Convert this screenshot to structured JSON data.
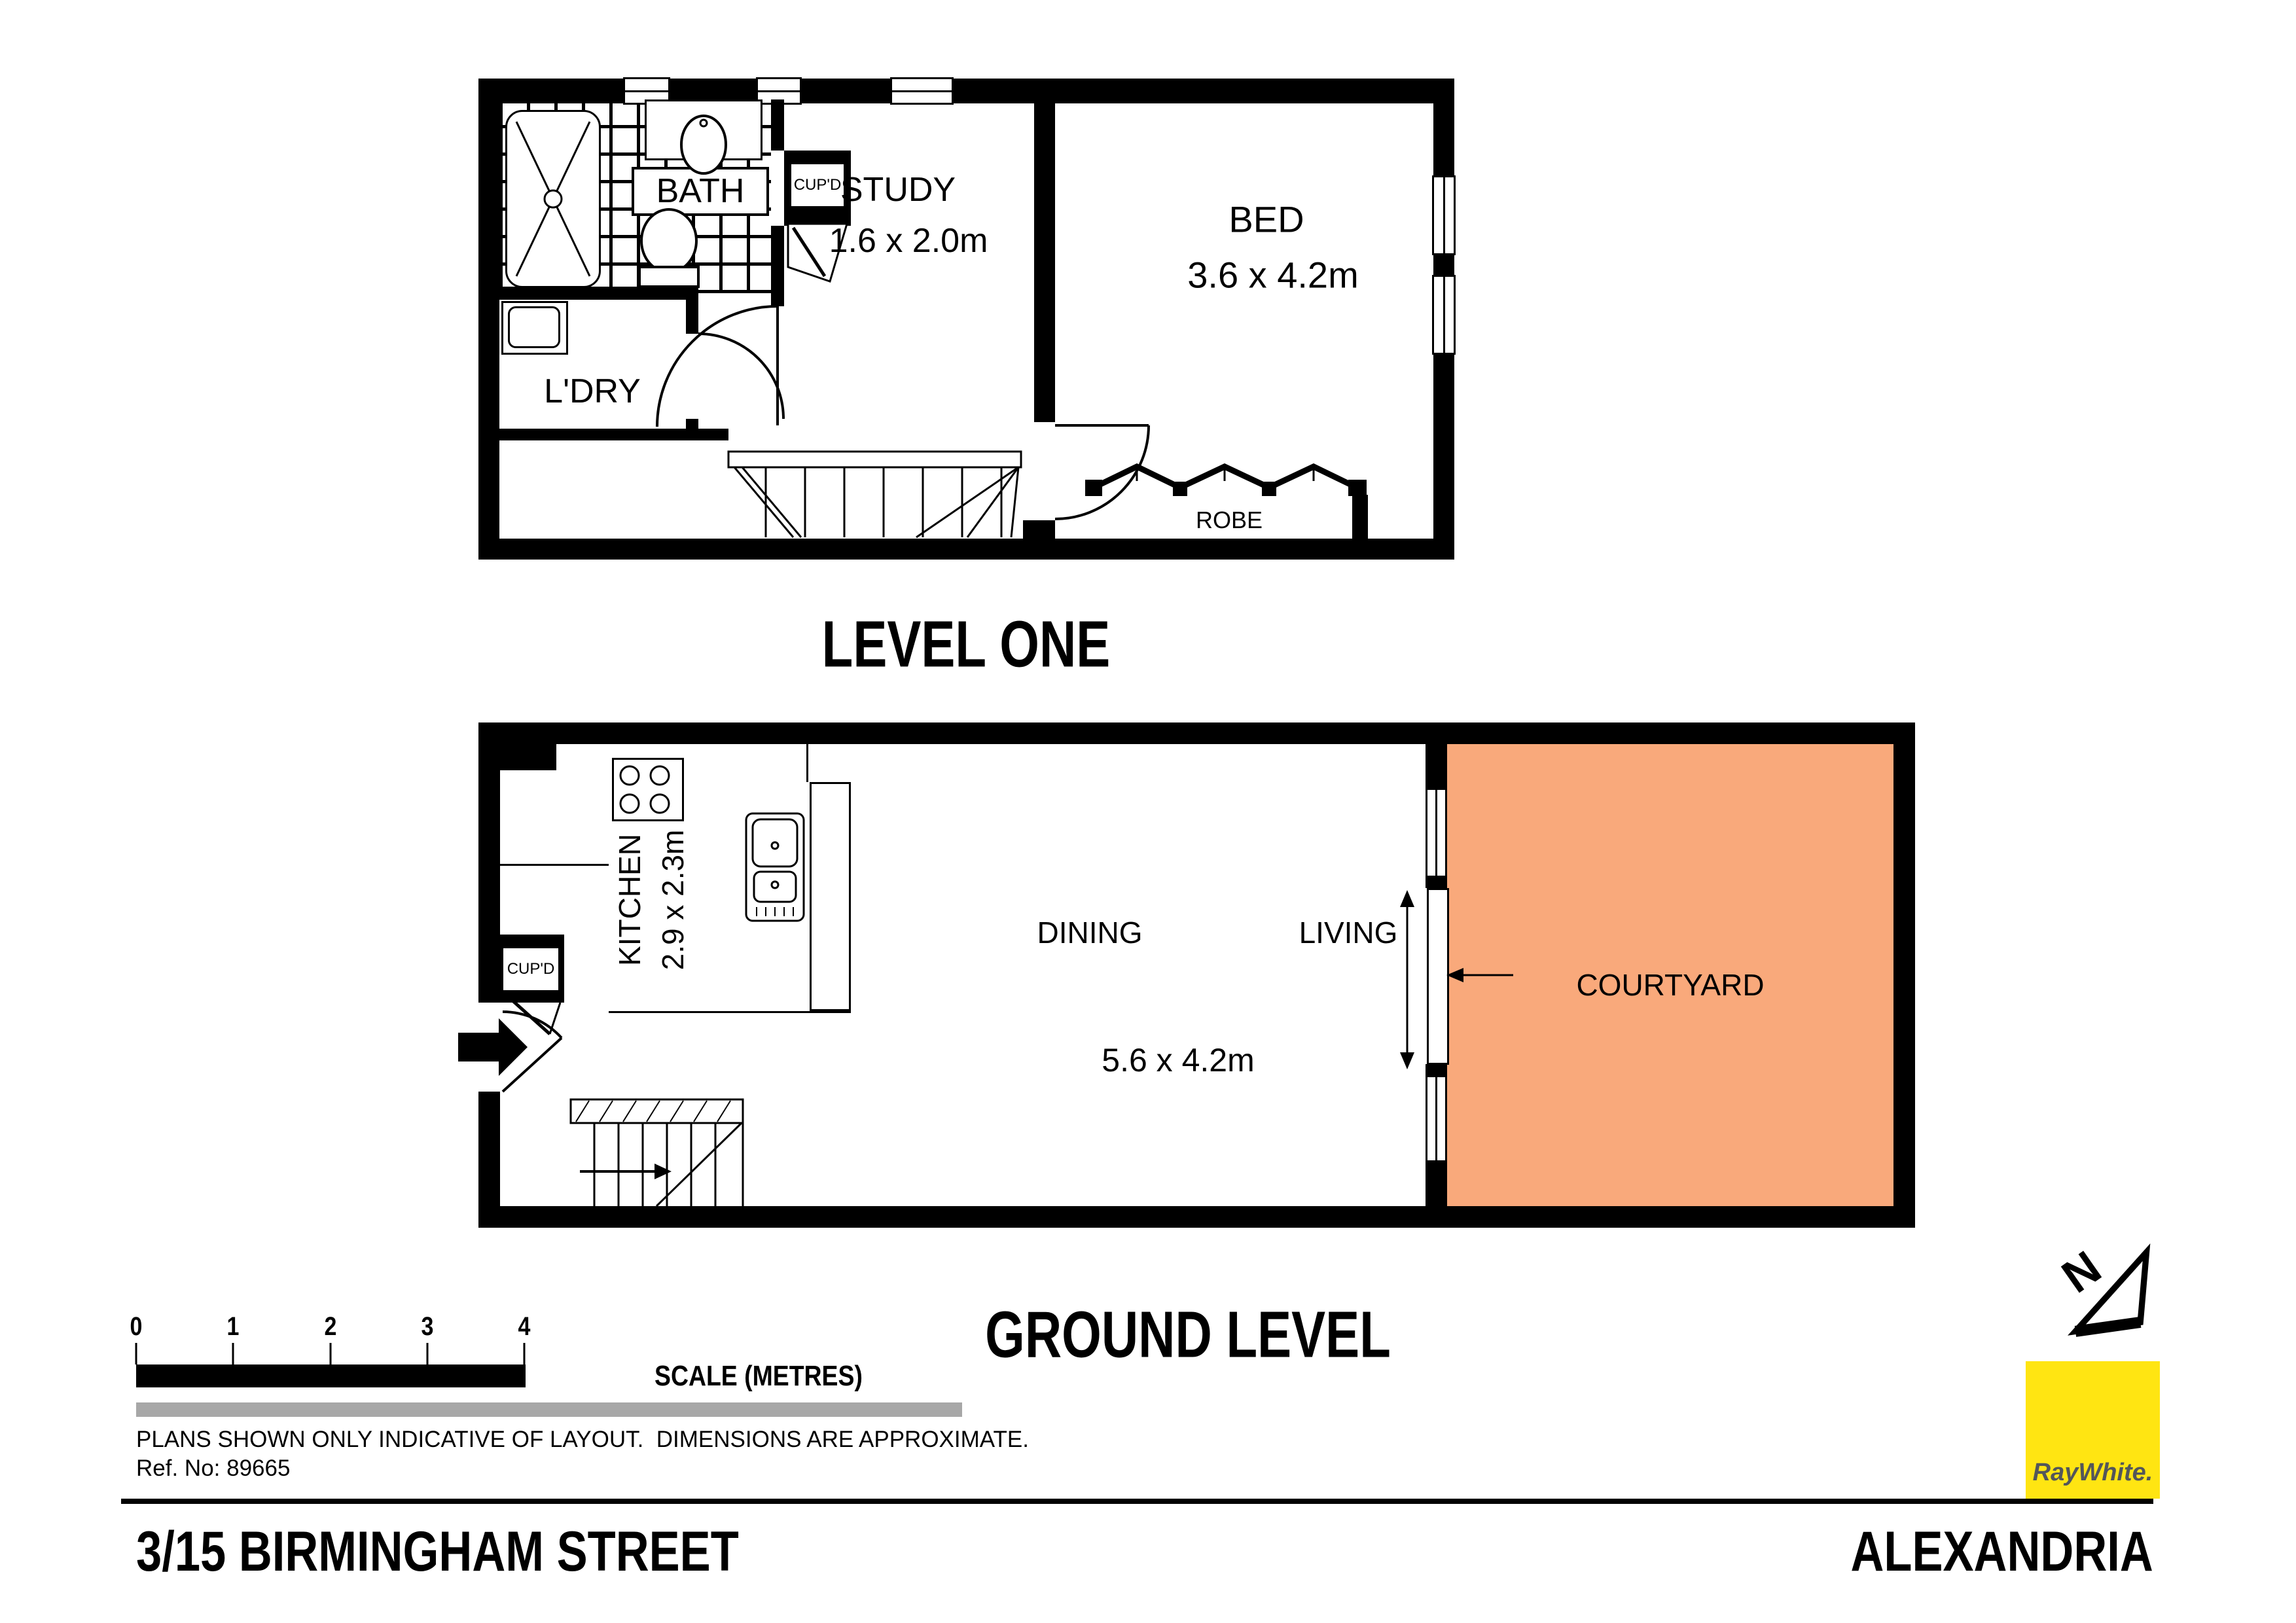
{
  "plan_upper": {
    "title": "LEVEL ONE",
    "rooms": {
      "bath": "BATH",
      "cupd": "CUP'D",
      "study": "STUDY",
      "study_dims": "1.6 x 2.0m",
      "bed": "BED",
      "bed_dims": "3.6 x 4.2m",
      "laundry": "L'DRY",
      "robe": "ROBE"
    }
  },
  "plan_ground": {
    "title": "GROUND LEVEL",
    "rooms": {
      "kitchen": "KITCHEN",
      "kitchen_dims": "2.9 x 2.3m",
      "cupd": "CUP'D",
      "dining": "DINING",
      "living": "LIVING",
      "living_dims": "5.6 x 4.2m",
      "courtyard": "COURTYARD"
    }
  },
  "scale_bar": {
    "ticks": [
      "0",
      "1",
      "2",
      "3",
      "4"
    ],
    "label": "SCALE (METRES)"
  },
  "notes": {
    "disclaimer": "PLANS SHOWN ONLY INDICATIVE OF LAYOUT.  DIMENSIONS ARE APPROXIMATE.",
    "ref": "Ref. No: 89665"
  },
  "footer": {
    "address": "3/15 BIRMINGHAM STREET",
    "suburb": "ALEXANDRIA"
  },
  "logo": {
    "brand": "RayWhite."
  },
  "colors": {
    "courtyard": "#F9A97B",
    "logo_yellow": "#FFE512",
    "logo_text": "#53565A",
    "gray_bar": "#A7A7A7"
  }
}
